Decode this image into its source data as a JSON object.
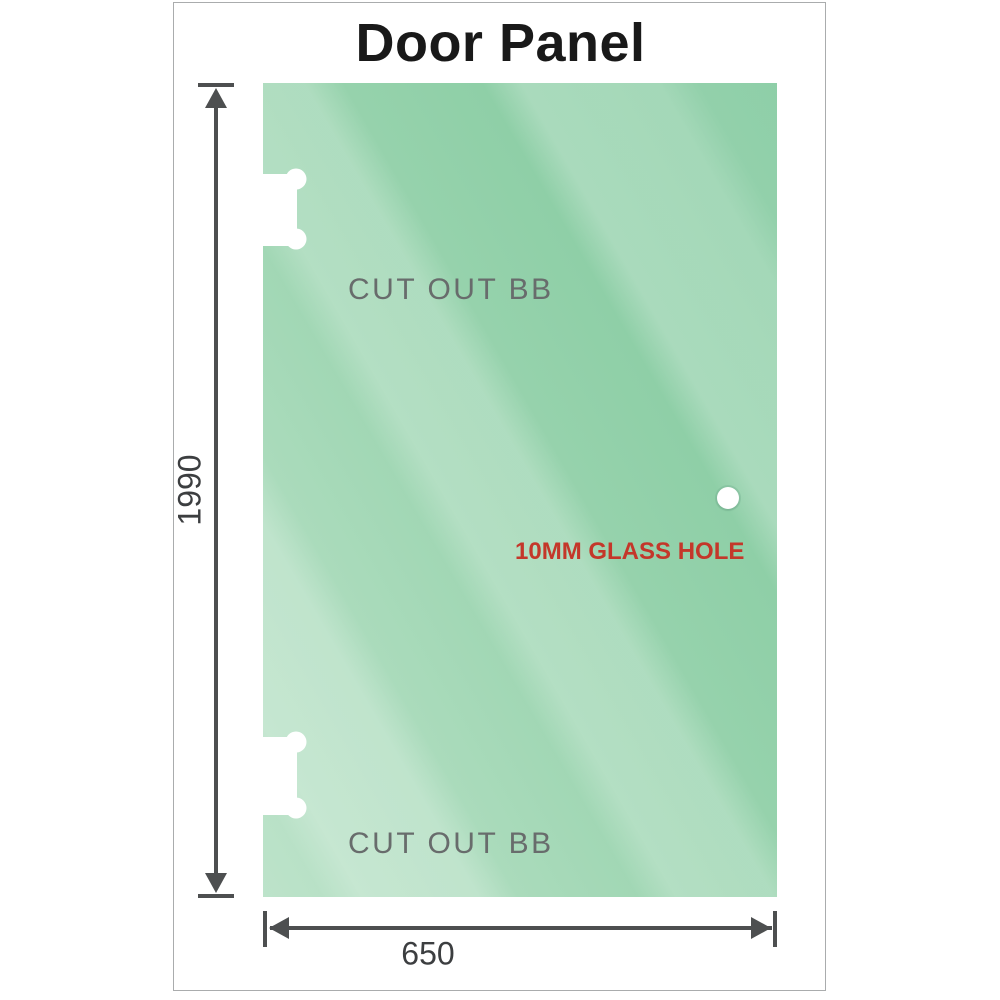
{
  "title": "Door Panel",
  "panel": {
    "cutout_top_label": "CUT OUT BB",
    "cutout_bottom_label": "CUT OUT BB",
    "hole_label": "10MM GLASS HOLE"
  },
  "dimensions": {
    "height_label": "1990",
    "width_label": "650",
    "height_mm": 1990,
    "width_mm": 650
  },
  "colors": {
    "title_color": "#191919",
    "frame_border": "#aaacad",
    "glass_dark": "#7fc89c",
    "glass_light": "#bde3ca",
    "label_gray": "#686c6c",
    "hole_red": "#c4372a",
    "dimension_line": "#4d4f50"
  }
}
